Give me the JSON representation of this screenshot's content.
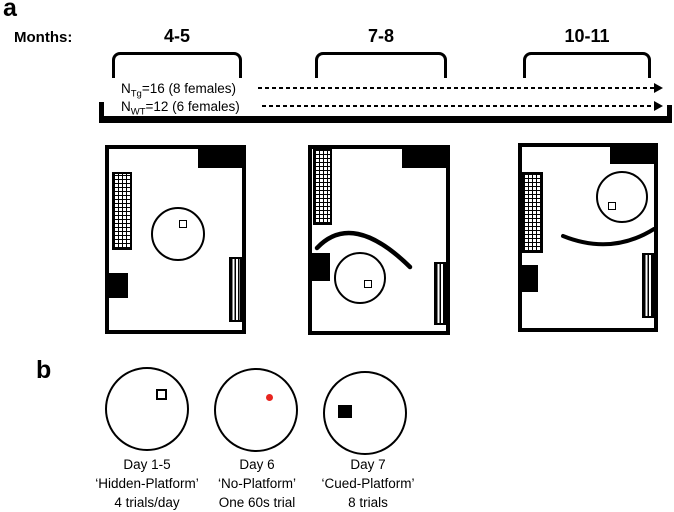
{
  "panel_a": {
    "label": "a",
    "months_label": "Months:",
    "age_groups": [
      "4-5",
      "7-8",
      "10-11"
    ],
    "cohorts": [
      {
        "prefix": "N",
        "subscript": "Tg",
        "rest": "=16 (8 females)"
      },
      {
        "prefix": "N",
        "subscript": "WT",
        "rest": "=12 (6 females)"
      }
    ]
  },
  "panel_b": {
    "label": "b",
    "phases": [
      {
        "day": "Day 1-5",
        "name": "‘Hidden-Platform’",
        "detail": "4 trials/day",
        "marker": "open-platform-square"
      },
      {
        "day": "Day 6",
        "name": "‘No-Platform’",
        "detail": "One 60s trial",
        "marker": "red-dot"
      },
      {
        "day": "Day 7",
        "name": "‘Cued-Platform’",
        "detail": "8 trials",
        "marker": "solid-platform-square"
      }
    ]
  },
  "colors": {
    "ink": "#000000",
    "red_dot": "#e8251f"
  }
}
